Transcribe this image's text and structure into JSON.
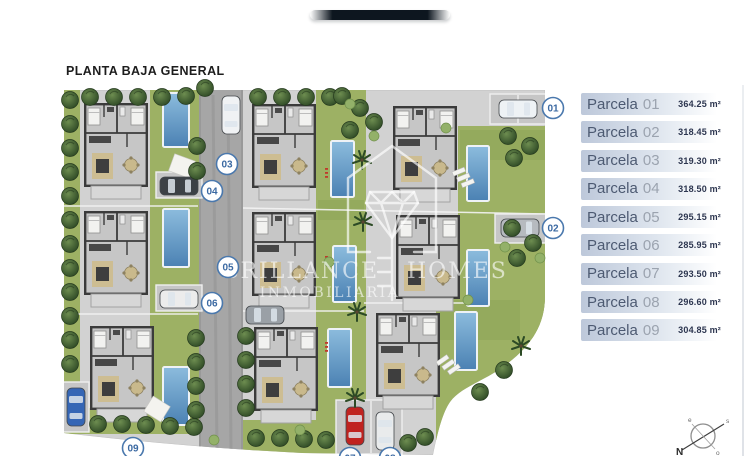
{
  "header": {
    "title": "PLANTA BAJA GENERAL"
  },
  "watermark": {
    "brand_left": "BRILLANCE",
    "brand_right": "HOMES",
    "subtitle": "INMOBILIARIA"
  },
  "parcel_list": {
    "label": "Parcela",
    "items": [
      {
        "number": "01",
        "area": "364.25 m²"
      },
      {
        "number": "02",
        "area": "318.45 m²"
      },
      {
        "number": "03",
        "area": "319.30 m²"
      },
      {
        "number": "04",
        "area": "318.50 m²"
      },
      {
        "number": "05",
        "area": "295.15 m²"
      },
      {
        "number": "06",
        "area": "285.95 m²"
      },
      {
        "number": "07",
        "area": "293.50 m²"
      },
      {
        "number": "08",
        "area": "296.60 m²"
      },
      {
        "number": "09",
        "area": "304.85 m²"
      }
    ]
  },
  "plan_markers": [
    {
      "label": "01",
      "x": 553,
      "y": 108
    },
    {
      "label": "02",
      "x": 553,
      "y": 228
    },
    {
      "label": "03",
      "x": 227,
      "y": 164
    },
    {
      "label": "04",
      "x": 212,
      "y": 191
    },
    {
      "label": "05",
      "x": 228,
      "y": 267
    },
    {
      "label": "06",
      "x": 212,
      "y": 303
    },
    {
      "label": "07",
      "x": 350,
      "y": 458
    },
    {
      "label": "08",
      "x": 390,
      "y": 458
    },
    {
      "label": "09",
      "x": 133,
      "y": 448
    }
  ],
  "compass": {
    "north": "N",
    "east": "e",
    "south": "s",
    "west": "o"
  },
  "colors": {
    "marker_blue": "#4a78ad",
    "panel_bar": "#bdc8da",
    "pool": "#5e90c1",
    "grass": "#9db164",
    "pavement": "#d2d2d2",
    "road": "#a6a6a6"
  }
}
